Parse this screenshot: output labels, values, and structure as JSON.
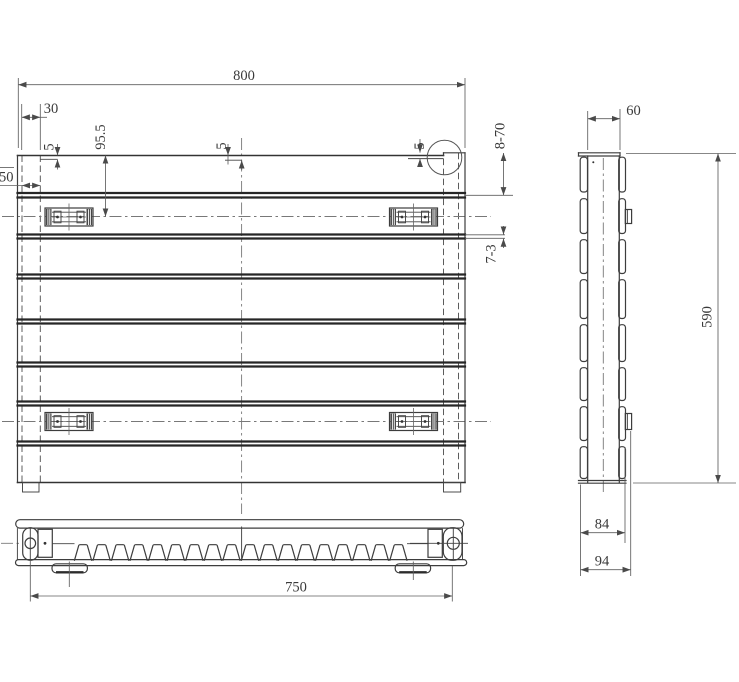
{
  "drawing": {
    "type": "technical-drawing",
    "subject": "Panel radiator three-view dimensioned drawing",
    "background": "#ffffff",
    "line_color": "#3a3a3a",
    "views": {
      "front": "front view",
      "side": "side view",
      "bottom": "bottom view"
    },
    "dims": {
      "overall_width": "800",
      "left_offset": "30",
      "bracket_drop": "95.5",
      "inset_left": "5",
      "inset_center": "5",
      "inset_right": "5",
      "edge_offset": "50",
      "panel_spec": "8-70",
      "gap_spec": "7-3",
      "depth": "60",
      "overall_height": "590",
      "body_depth": "84",
      "total_depth": "94",
      "tapping_span": "750"
    }
  }
}
